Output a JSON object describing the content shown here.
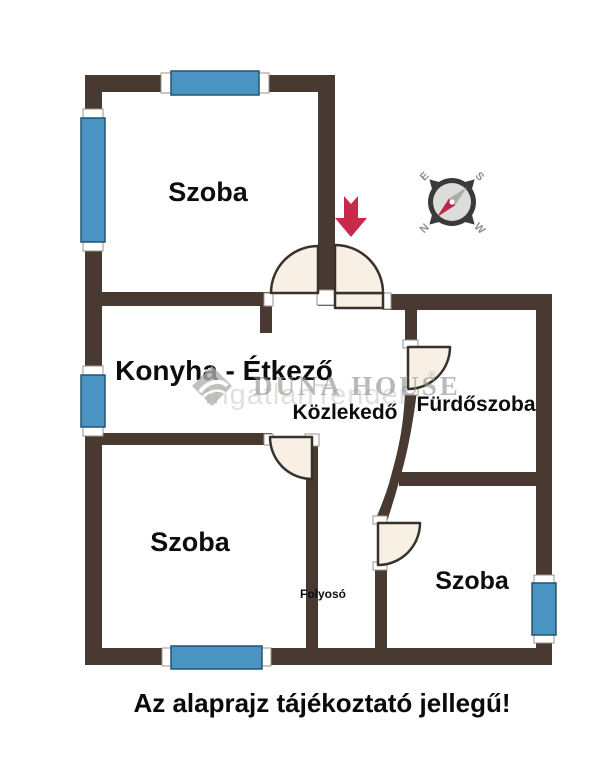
{
  "plan": {
    "rooms": {
      "room_top": "Szoba",
      "kitchen_dining": "Konyha - Étkező",
      "hallway": "Közlekedő",
      "bathroom": "Fürdőszoba",
      "room_bottom_left": "Szoba",
      "room_bottom_right": "Szoba",
      "corridor": "Folyosó"
    },
    "caption": "Az alaprajz tájékoztató jellegű!",
    "compass": {
      "north": "N",
      "south": "S",
      "east": "E",
      "west": "W"
    },
    "watermark": {
      "brand": "DUNA HOUSE",
      "secondary": "ingatlanTender",
      "registered": "®"
    },
    "colors": {
      "wall": "#483a30",
      "window": "#4a94c4",
      "door_fill": "#f8f0e4",
      "arrow": "#c8294d",
      "label": "#0d0d0d"
    }
  }
}
